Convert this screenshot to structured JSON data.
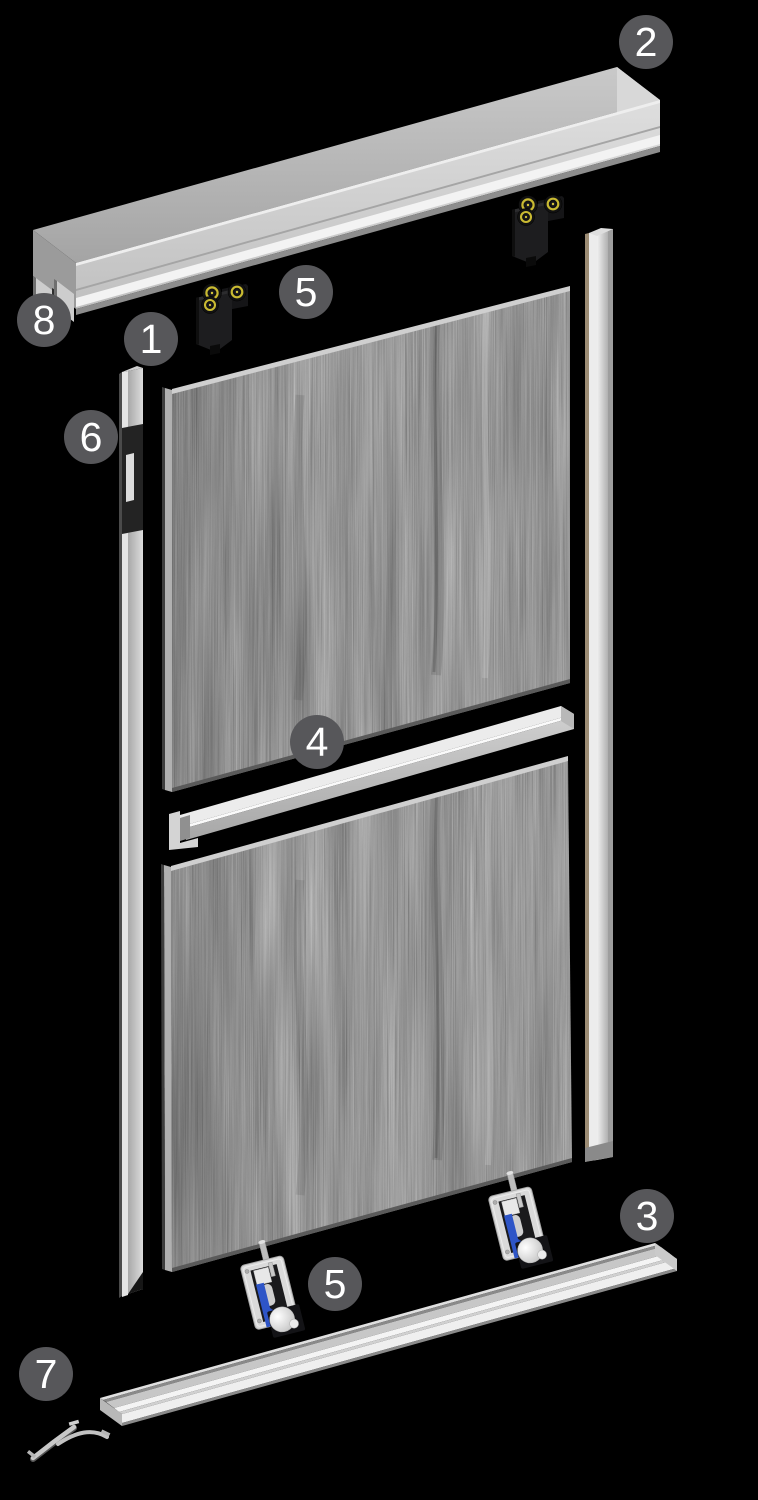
{
  "diagram": {
    "type": "exploded-parts-diagram",
    "subject": "sliding-door-system",
    "background": "#000000",
    "callouts": [
      {
        "label": "2"
      },
      {
        "label": "8"
      },
      {
        "label": "1"
      },
      {
        "label": "5"
      },
      {
        "label": "6"
      },
      {
        "label": "4"
      },
      {
        "label": "3"
      },
      {
        "label": "5"
      },
      {
        "label": "7"
      }
    ],
    "colors": {
      "callout_fill": "#57575a",
      "callout_text": "#ffffff",
      "aluminum_light": "#ececec",
      "aluminum_mid": "#b8b8b8",
      "aluminum_dark": "#8a8a8a",
      "panel_gray": "#9a9a9a",
      "roller_black": "#1d1d1f",
      "wheel_ring_yellow": "#c9ba32",
      "glider_blue": "#2e55c7",
      "profile_bronze": "#9c8c74"
    }
  }
}
